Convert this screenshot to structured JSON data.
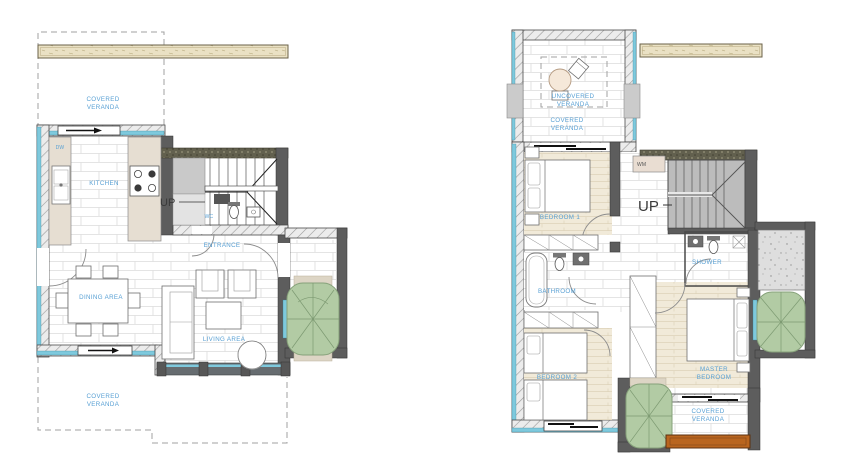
{
  "page": {
    "title": "Two-storey house floor plans",
    "background": "#ffffff"
  },
  "colors": {
    "label_blue": "#58a0d4",
    "wall_dark": "#5d5d5d",
    "window_cyan": "#7ec9dd",
    "tree_green": "#b2cba4",
    "wood_floor": "#f1ead9",
    "counter_beige": "#e6ded2",
    "beam_tan": "#eae1c4",
    "railing_orange": "#b9651f",
    "stair_gray": "#bcbcbc",
    "concrete_gray": "#dedede"
  },
  "ground_floor": {
    "labels": {
      "veranda_top": [
        "COVERED",
        "VERANDA"
      ],
      "dw": "DW",
      "kitchen": "KITCHEN",
      "up": "UP",
      "wc": "WC",
      "entrance": "ENTRANCE",
      "dining": "DINING AREA",
      "living": "LIVING AREA",
      "veranda_bottom": [
        "COVERED",
        "VERANDA"
      ]
    }
  },
  "first_floor": {
    "labels": {
      "uncovered_veranda": [
        "UNCOVERED",
        "VERANDA"
      ],
      "covered_veranda_top": [
        "COVERED",
        "VERANDA"
      ],
      "wm": "WM",
      "bedroom1": "BEDROOM 1",
      "up": "UP",
      "shower": "SHOWER",
      "bathroom": "BATHROOM",
      "bedroom2": "BEDROOM 2",
      "master": [
        "MASTER",
        "BEDROOM"
      ],
      "covered_veranda_bottom": [
        "COVERED",
        "VERANDA"
      ]
    }
  }
}
